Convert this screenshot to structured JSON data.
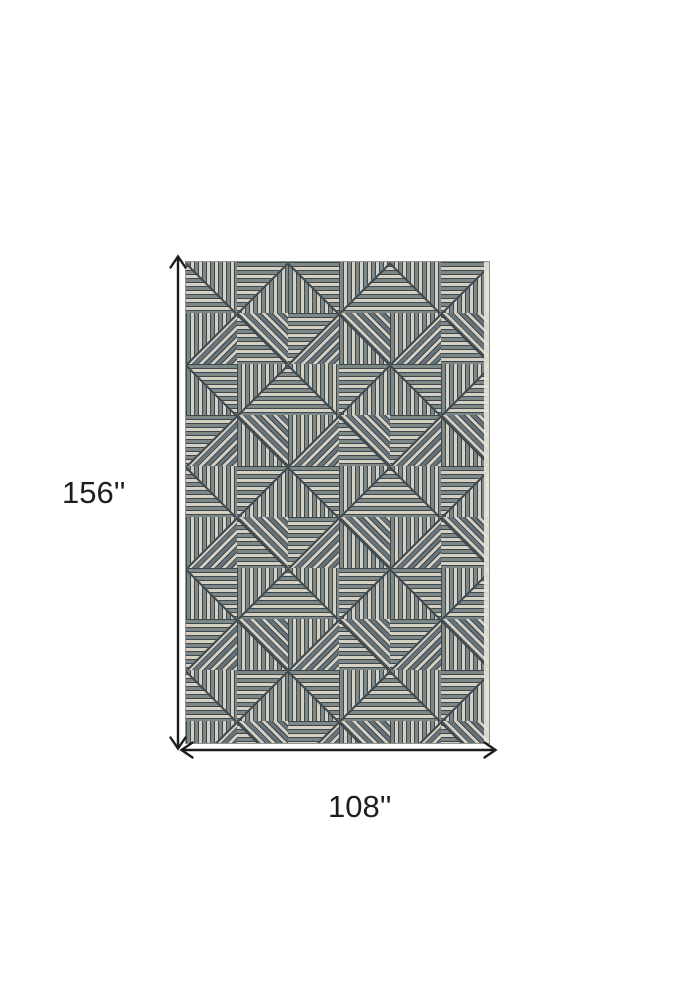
{
  "diagram": {
    "height_dimension": {
      "label": "156''"
    },
    "width_dimension": {
      "label": "108''"
    },
    "arrow_color": "#1c1c1c",
    "rug": {
      "pattern": "striped-triangle-geometric",
      "colors": {
        "cream": "#d5d0c2",
        "gray": "#7d8786",
        "gray_dark": "#67737a",
        "outline": "#3c484e",
        "selvage": "#e8e5dc"
      }
    }
  }
}
